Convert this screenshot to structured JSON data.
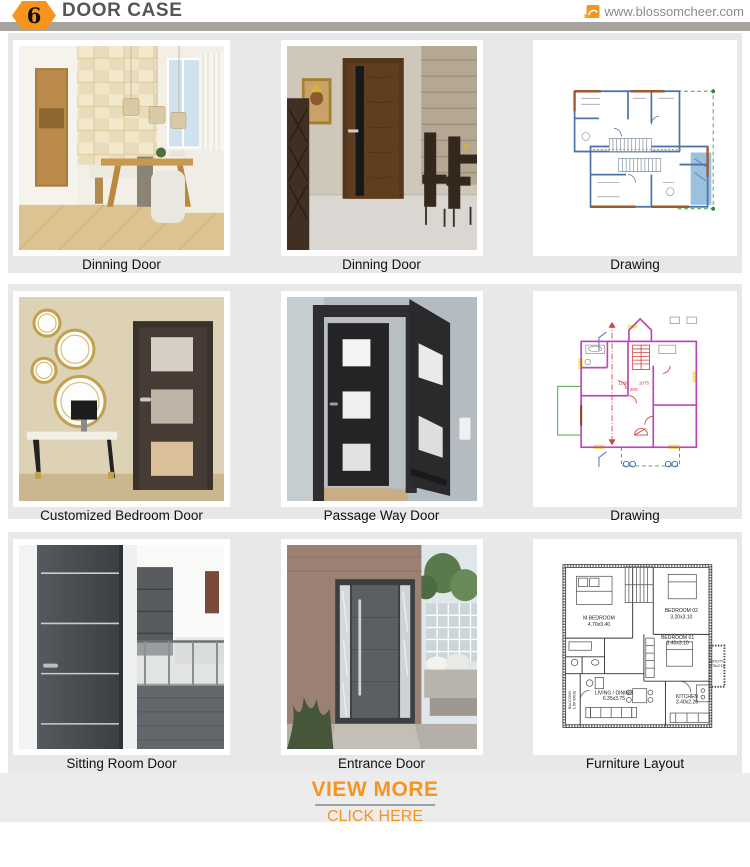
{
  "header": {
    "badge": "6",
    "title": "DOOR CASE",
    "website": "www.blossomcheer.com"
  },
  "colors": {
    "accent_orange": "#F7941E",
    "header_bar_gray": "#A7A39E",
    "panel_gray": "#E8E8E8",
    "title_text": "#55565A",
    "caption_text": "#111111"
  },
  "icons": {
    "badge_shape": "orange-hexagon",
    "logo": "orange-box-logo-icon"
  },
  "cards": [
    {
      "caption": "Dinning Door",
      "image": "dining-room-with-wooden-door-photo"
    },
    {
      "caption": "Dinning Door",
      "image": "dark-walnut-door-with-black-glass-stripe-photo"
    },
    {
      "caption": "Drawing",
      "image": "blue-architectural-floor-plan"
    },
    {
      "caption": "Customized Bedroom Door",
      "image": "dark-bedroom-door-with-frosted-panels-photo"
    },
    {
      "caption": "Passage Way Door",
      "image": "open-black-door-with-glass-squares-photo"
    },
    {
      "caption": "Drawing",
      "image": "pink-architectural-floor-plan"
    },
    {
      "caption": "Sitting Room Door",
      "image": "grey-flush-door-with-metal-inlays-photo"
    },
    {
      "caption": "Entrance Door",
      "image": "modern-entrance-pivot-door-photo"
    },
    {
      "caption": "Furniture Layout",
      "image": "furniture-layout-floor-plan"
    }
  ],
  "furniture_layout": {
    "rooms": [
      {
        "name": "M.BEDROOM",
        "dim": "4.70x3.40"
      },
      {
        "name": "BEDROOM 02",
        "dim": "3.20x3.10"
      },
      {
        "name": "BEDROOM 01",
        "dim": "3.40x3.10"
      },
      {
        "name": "UTILITY",
        "dim": "1.70x2.10"
      },
      {
        "name": "KITCHEN",
        "dim": "3.40x2.20"
      },
      {
        "name": "LIVING / DINING",
        "dim": "6.35x3.75"
      },
      {
        "name": "BALCONY",
        "dim": "1.50 WIDE"
      }
    ]
  },
  "plan_annotations": {
    "pink_dims": [
      "1130",
      "1075",
      "200"
    ]
  },
  "footer": {
    "view_more": "VIEW MORE",
    "click_here": "CLICK HERE"
  }
}
